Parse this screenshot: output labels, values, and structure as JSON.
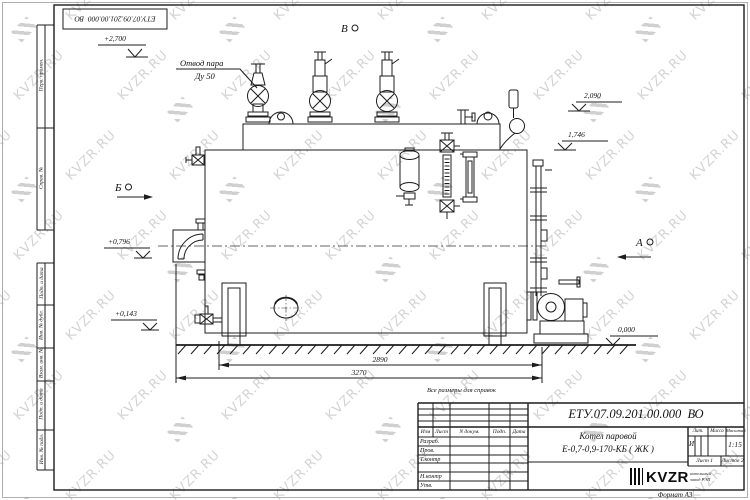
{
  "watermark": {
    "text": "KVZR.RU"
  },
  "frame": {
    "stamp": "ЕТУ.07.09.201.00.000  ВО",
    "top_cells": [
      "Перв. примен.",
      "Справ. №"
    ],
    "bottom_cells": [
      "Подп. и дата",
      "Инв. № дубл.",
      "Взам. инв. №",
      "Подп. и дата",
      "Инв. № подл."
    ],
    "format_note": "Формат А3"
  },
  "drawing": {
    "steam_label_line1": "Отвод пара",
    "steam_label_line2": "Ду 50",
    "levels": {
      "l2700": "+2,700",
      "l2090": "2,090",
      "l1746": "1,746",
      "l0796": "+0,796",
      "l0143": "+0,143",
      "l0000": "0,000"
    },
    "views": {
      "top": "В",
      "left": "Б",
      "right": "А"
    },
    "dims": {
      "inner": "2890",
      "overall": "3270"
    },
    "note": "Все размеры для справок"
  },
  "title_block": {
    "doc_number": "ЕТУ.07.09.201.00.000  ВО",
    "name_line1": "Котел паровой",
    "name_line2": "Е-0,7-0,9-170-КБ ( ЖК )",
    "columns": {
      "izm": "Изм",
      "list": "Лист",
      "ndok": "N докум.",
      "podp": "Подп.",
      "data": "Дата"
    },
    "rows": {
      "razrab": "Разраб.",
      "prov": "Пров.",
      "tkontr": "Т.контр",
      "nkontr": "Н.контр",
      "utv": "Утв."
    },
    "lit_header": "Лит.",
    "mass_header": "Масса",
    "scale_header": "Масштаб",
    "lit_value": "И",
    "scale_value": "1:15",
    "sheet": "Лист 1",
    "sheets": "Листов 2",
    "logo_text": "KVZR",
    "logo_caption_line1": "котельный",
    "logo_caption_line2": "завод РЭП"
  }
}
